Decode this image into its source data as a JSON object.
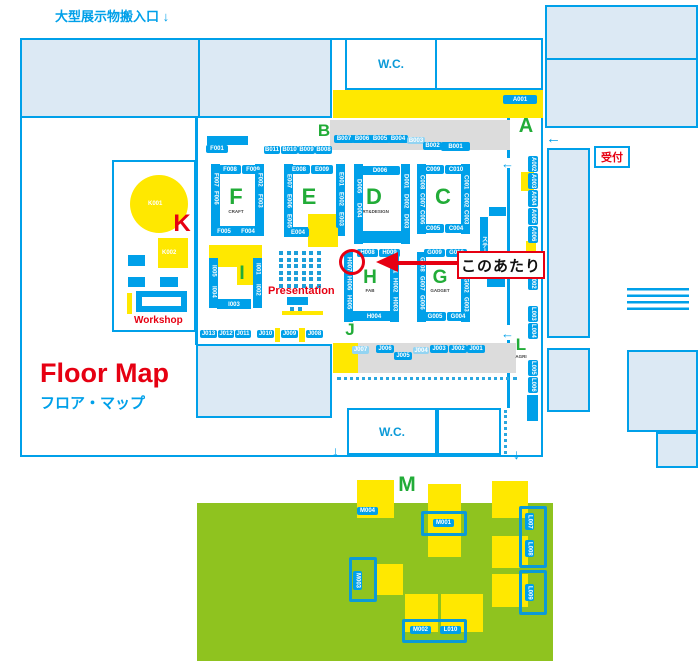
{
  "texts": {
    "carry_in": "大型展示物搬入口 ↓",
    "floor_map": "Floor Map",
    "floor_map_ja": "フロア・マップ",
    "wc_top": "W.C.",
    "wc_bottom": "W.C.",
    "reception": "受付",
    "workshop": "Workshop",
    "presentation": "Presentation",
    "around_here": "このあたり",
    "stage": "ステージ",
    "k001": "K001",
    "k002": "K002",
    "arrow_left": "←",
    "arrow_down": "↓"
  },
  "colors": {
    "blue": "#00a0e9",
    "light_blue_fill": "#dce9f4",
    "yellow": "#ffe800",
    "zone_green": "#22ac38",
    "grass_green": "#8fc31f",
    "red": "#e60012",
    "grey": "#dcdcdc"
  },
  "zones": [
    {
      "letter": "A",
      "x": 512,
      "y": 116,
      "size": 20
    },
    {
      "letter": "B",
      "x": 310,
      "y": 122,
      "size": 17
    },
    {
      "letter": "C",
      "x": 429,
      "y": 186,
      "size": 22
    },
    {
      "letter": "D",
      "x": 360,
      "y": 186,
      "size": 22,
      "sub": "ART&DESIGN"
    },
    {
      "letter": "E",
      "x": 295,
      "y": 186,
      "size": 22
    },
    {
      "letter": "F",
      "x": 222,
      "y": 186,
      "size": 22,
      "sub": "CRAFT"
    },
    {
      "letter": "G",
      "x": 426,
      "y": 268,
      "size": 19,
      "sub": "GADGET"
    },
    {
      "letter": "H",
      "x": 356,
      "y": 268,
      "size": 19,
      "sub": "FAB"
    },
    {
      "letter": "I",
      "x": 228,
      "y": 264,
      "size": 19
    },
    {
      "letter": "J",
      "x": 336,
      "y": 321,
      "size": 17
    },
    {
      "letter": "K",
      "x": 168,
      "y": 212,
      "size": 24,
      "red": true
    },
    {
      "letter": "L",
      "x": 507,
      "y": 336,
      "size": 17,
      "sub": "AGRI"
    },
    {
      "letter": "M",
      "x": 393,
      "y": 474,
      "size": 21
    }
  ],
  "booths": [
    {
      "id": "A001",
      "x": 503,
      "y": 95,
      "w": 34,
      "h": 9
    },
    {
      "id": "A002",
      "x": 528,
      "y": 156,
      "w": 10,
      "h": 16,
      "v": true
    },
    {
      "id": "A003",
      "x": 528,
      "y": 173,
      "w": 10,
      "h": 16,
      "v": true
    },
    {
      "id": "A004",
      "x": 528,
      "y": 190,
      "w": 10,
      "h": 17,
      "v": true
    },
    {
      "id": "A005",
      "x": 528,
      "y": 208,
      "w": 10,
      "h": 17,
      "v": true
    },
    {
      "id": "A006",
      "x": 528,
      "y": 226,
      "w": 10,
      "h": 17,
      "v": true
    },
    {
      "id": "L001",
      "x": 528,
      "y": 257,
      "w": 10,
      "h": 16,
      "v": true
    },
    {
      "id": "L002",
      "x": 528,
      "y": 274,
      "w": 10,
      "h": 16,
      "v": true
    },
    {
      "id": "L003",
      "x": 528,
      "y": 306,
      "w": 10,
      "h": 16,
      "v": true
    },
    {
      "id": "L004",
      "x": 528,
      "y": 323,
      "w": 10,
      "h": 16,
      "v": true
    },
    {
      "id": "L005",
      "x": 528,
      "y": 360,
      "w": 10,
      "h": 16,
      "v": true
    },
    {
      "id": "L006",
      "x": 528,
      "y": 377,
      "w": 10,
      "h": 16,
      "v": true
    },
    {
      "id": "B007",
      "x": 334,
      "y": 135,
      "w": 20,
      "h": 8
    },
    {
      "id": "B006",
      "x": 352,
      "y": 135,
      "w": 20,
      "h": 8
    },
    {
      "id": "B005",
      "x": 370,
      "y": 135,
      "w": 20,
      "h": 8
    },
    {
      "id": "B004",
      "x": 388,
      "y": 135,
      "w": 20,
      "h": 8
    },
    {
      "id": "B003",
      "x": 407,
      "y": 137,
      "w": 18,
      "h": 7,
      "f": true
    },
    {
      "id": "B002",
      "x": 423,
      "y": 142,
      "w": 19,
      "h": 8
    },
    {
      "id": "B001",
      "x": 441,
      "y": 142,
      "w": 29,
      "h": 9
    },
    {
      "id": "B011",
      "x": 264,
      "y": 146,
      "w": 16,
      "h": 8
    },
    {
      "id": "B010",
      "x": 281,
      "y": 146,
      "w": 17,
      "h": 8
    },
    {
      "id": "B009",
      "x": 298,
      "y": 146,
      "w": 17,
      "h": 8
    },
    {
      "id": "B008",
      "x": 315,
      "y": 146,
      "w": 17,
      "h": 8
    },
    {
      "id": "F001",
      "x": 206,
      "y": 145,
      "w": 22,
      "h": 8
    },
    {
      "id": "F008",
      "x": 219,
      "y": 165,
      "w": 22,
      "h": 9
    },
    {
      "id": "F009",
      "x": 242,
      "y": 165,
      "w": 22,
      "h": 9
    },
    {
      "id": "F007",
      "x": 211,
      "y": 173,
      "w": 9,
      "h": 13,
      "v": true
    },
    {
      "id": "F006",
      "x": 211,
      "y": 188,
      "w": 9,
      "h": 19,
      "v": true
    },
    {
      "id": "F002",
      "x": 255,
      "y": 170,
      "w": 9,
      "h": 19,
      "v": true
    },
    {
      "id": "F003",
      "x": 255,
      "y": 191,
      "w": 9,
      "h": 19,
      "v": true
    },
    {
      "id": "F005",
      "x": 213,
      "y": 227,
      "w": 22,
      "h": 9
    },
    {
      "id": "F004",
      "x": 237,
      "y": 227,
      "w": 22,
      "h": 9
    },
    {
      "id": "E008",
      "x": 288,
      "y": 165,
      "w": 22,
      "h": 9
    },
    {
      "id": "E009",
      "x": 311,
      "y": 165,
      "w": 22,
      "h": 9
    },
    {
      "id": "E007",
      "x": 284,
      "y": 172,
      "w": 9,
      "h": 18,
      "v": true
    },
    {
      "id": "E006",
      "x": 284,
      "y": 192,
      "w": 9,
      "h": 18,
      "v": true
    },
    {
      "id": "E005",
      "x": 284,
      "y": 212,
      "w": 9,
      "h": 18,
      "v": true
    },
    {
      "id": "E001",
      "x": 336,
      "y": 170,
      "w": 9,
      "h": 18,
      "v": true
    },
    {
      "id": "E002",
      "x": 336,
      "y": 190,
      "w": 9,
      "h": 18,
      "v": true
    },
    {
      "id": "E003",
      "x": 336,
      "y": 210,
      "w": 9,
      "h": 18,
      "v": true
    },
    {
      "id": "E004",
      "x": 287,
      "y": 228,
      "w": 22,
      "h": 9
    },
    {
      "id": "D006",
      "x": 360,
      "y": 166,
      "w": 40,
      "h": 9
    },
    {
      "id": "D005",
      "x": 354,
      "y": 176,
      "w": 9,
      "h": 20,
      "v": true
    },
    {
      "id": "D004",
      "x": 354,
      "y": 200,
      "w": 9,
      "h": 20,
      "v": true
    },
    {
      "id": "D001",
      "x": 401,
      "y": 172,
      "w": 9,
      "h": 18,
      "v": true
    },
    {
      "id": "D002",
      "x": 401,
      "y": 192,
      "w": 9,
      "h": 18,
      "v": true
    },
    {
      "id": "D003",
      "x": 401,
      "y": 212,
      "w": 9,
      "h": 18,
      "v": true
    },
    {
      "id": "C009",
      "x": 422,
      "y": 165,
      "w": 22,
      "h": 9
    },
    {
      "id": "C010",
      "x": 445,
      "y": 165,
      "w": 22,
      "h": 9
    },
    {
      "id": "C008",
      "x": 417,
      "y": 174,
      "w": 9,
      "h": 17,
      "v": true
    },
    {
      "id": "C007",
      "x": 417,
      "y": 192,
      "w": 9,
      "h": 17,
      "v": true
    },
    {
      "id": "C006",
      "x": 417,
      "y": 209,
      "w": 9,
      "h": 17,
      "v": true
    },
    {
      "id": "C001",
      "x": 461,
      "y": 174,
      "w": 9,
      "h": 17,
      "v": true
    },
    {
      "id": "C002",
      "x": 461,
      "y": 192,
      "w": 9,
      "h": 17,
      "v": true
    },
    {
      "id": "C003",
      "x": 461,
      "y": 209,
      "w": 9,
      "h": 17,
      "v": true
    },
    {
      "id": "C005",
      "x": 422,
      "y": 224,
      "w": 22,
      "h": 9
    },
    {
      "id": "C004",
      "x": 445,
      "y": 224,
      "w": 22,
      "h": 9
    },
    {
      "id": "H008",
      "x": 357,
      "y": 249,
      "w": 21,
      "h": 8
    },
    {
      "id": "H009",
      "x": 379,
      "y": 249,
      "w": 21,
      "h": 8
    },
    {
      "id": "H007",
      "x": 344,
      "y": 256,
      "w": 9,
      "h": 17,
      "v": true
    },
    {
      "id": "H006",
      "x": 344,
      "y": 275,
      "w": 9,
      "h": 17,
      "v": true
    },
    {
      "id": "H005",
      "x": 344,
      "y": 294,
      "w": 9,
      "h": 17,
      "v": true
    },
    {
      "id": "H001",
      "x": 390,
      "y": 258,
      "w": 9,
      "h": 17,
      "v": true
    },
    {
      "id": "H002",
      "x": 390,
      "y": 277,
      "w": 9,
      "h": 17,
      "v": true
    },
    {
      "id": "H003",
      "x": 390,
      "y": 296,
      "w": 9,
      "h": 17,
      "v": true
    },
    {
      "id": "H004",
      "x": 362,
      "y": 312,
      "w": 24,
      "h": 9
    },
    {
      "id": "G009",
      "x": 424,
      "y": 249,
      "w": 21,
      "h": 8
    },
    {
      "id": "G010",
      "x": 446,
      "y": 249,
      "w": 21,
      "h": 8
    },
    {
      "id": "G008",
      "x": 417,
      "y": 256,
      "w": 9,
      "h": 17,
      "v": true
    },
    {
      "id": "G007",
      "x": 417,
      "y": 275,
      "w": 9,
      "h": 17,
      "v": true
    },
    {
      "id": "G006",
      "x": 417,
      "y": 294,
      "w": 9,
      "h": 17,
      "v": true
    },
    {
      "id": "G001",
      "x": 461,
      "y": 258,
      "w": 9,
      "h": 17,
      "v": true
    },
    {
      "id": "G002",
      "x": 461,
      "y": 277,
      "w": 9,
      "h": 17,
      "v": true
    },
    {
      "id": "G003",
      "x": 461,
      "y": 296,
      "w": 9,
      "h": 17,
      "v": true
    },
    {
      "id": "G005",
      "x": 424,
      "y": 312,
      "w": 22,
      "h": 9
    },
    {
      "id": "G004",
      "x": 447,
      "y": 312,
      "w": 22,
      "h": 9
    },
    {
      "id": "I005",
      "x": 209,
      "y": 262,
      "w": 9,
      "h": 17,
      "v": true
    },
    {
      "id": "I004",
      "x": 209,
      "y": 283,
      "w": 9,
      "h": 17,
      "v": true
    },
    {
      "id": "I001",
      "x": 253,
      "y": 260,
      "w": 9,
      "h": 17,
      "v": true
    },
    {
      "id": "I002",
      "x": 253,
      "y": 281,
      "w": 9,
      "h": 17,
      "v": true
    },
    {
      "id": "I003",
      "x": 221,
      "y": 300,
      "w": 26,
      "h": 9
    },
    {
      "id": "J013",
      "x": 200,
      "y": 330,
      "w": 17,
      "h": 8
    },
    {
      "id": "J012",
      "x": 218,
      "y": 330,
      "w": 16,
      "h": 8
    },
    {
      "id": "J011",
      "x": 235,
      "y": 330,
      "w": 16,
      "h": 8
    },
    {
      "id": "J010",
      "x": 257,
      "y": 330,
      "w": 17,
      "h": 8
    },
    {
      "id": "J009",
      "x": 281,
      "y": 330,
      "w": 17,
      "h": 8
    },
    {
      "id": "J008",
      "x": 306,
      "y": 330,
      "w": 17,
      "h": 8
    },
    {
      "id": "J007",
      "x": 352,
      "y": 346,
      "w": 17,
      "h": 8,
      "f": true
    },
    {
      "id": "J006",
      "x": 376,
      "y": 345,
      "w": 18,
      "h": 8
    },
    {
      "id": "J005",
      "x": 394,
      "y": 352,
      "w": 18,
      "h": 8
    },
    {
      "id": "J004",
      "x": 413,
      "y": 347,
      "w": 16,
      "h": 7,
      "f": true
    },
    {
      "id": "J003",
      "x": 430,
      "y": 345,
      "w": 18,
      "h": 8
    },
    {
      "id": "J002",
      "x": 449,
      "y": 345,
      "w": 18,
      "h": 8
    },
    {
      "id": "J001",
      "x": 467,
      "y": 345,
      "w": 18,
      "h": 8
    },
    {
      "id": "M004",
      "x": 357,
      "y": 507,
      "w": 21,
      "h": 8
    },
    {
      "id": "M001",
      "x": 433,
      "y": 519,
      "w": 21,
      "h": 8
    },
    {
      "id": "M003",
      "x": 353,
      "y": 571,
      "w": 9,
      "h": 19,
      "v": true
    },
    {
      "id": "M002",
      "x": 410,
      "y": 626,
      "w": 21,
      "h": 8
    },
    {
      "id": "L010",
      "x": 440,
      "y": 626,
      "w": 21,
      "h": 8
    },
    {
      "id": "L007",
      "x": 525,
      "y": 513,
      "w": 9,
      "h": 17,
      "v": true
    },
    {
      "id": "L008",
      "x": 525,
      "y": 540,
      "w": 9,
      "h": 17,
      "v": true
    },
    {
      "id": "L009",
      "x": 525,
      "y": 584,
      "w": 9,
      "h": 17,
      "v": true
    }
  ]
}
